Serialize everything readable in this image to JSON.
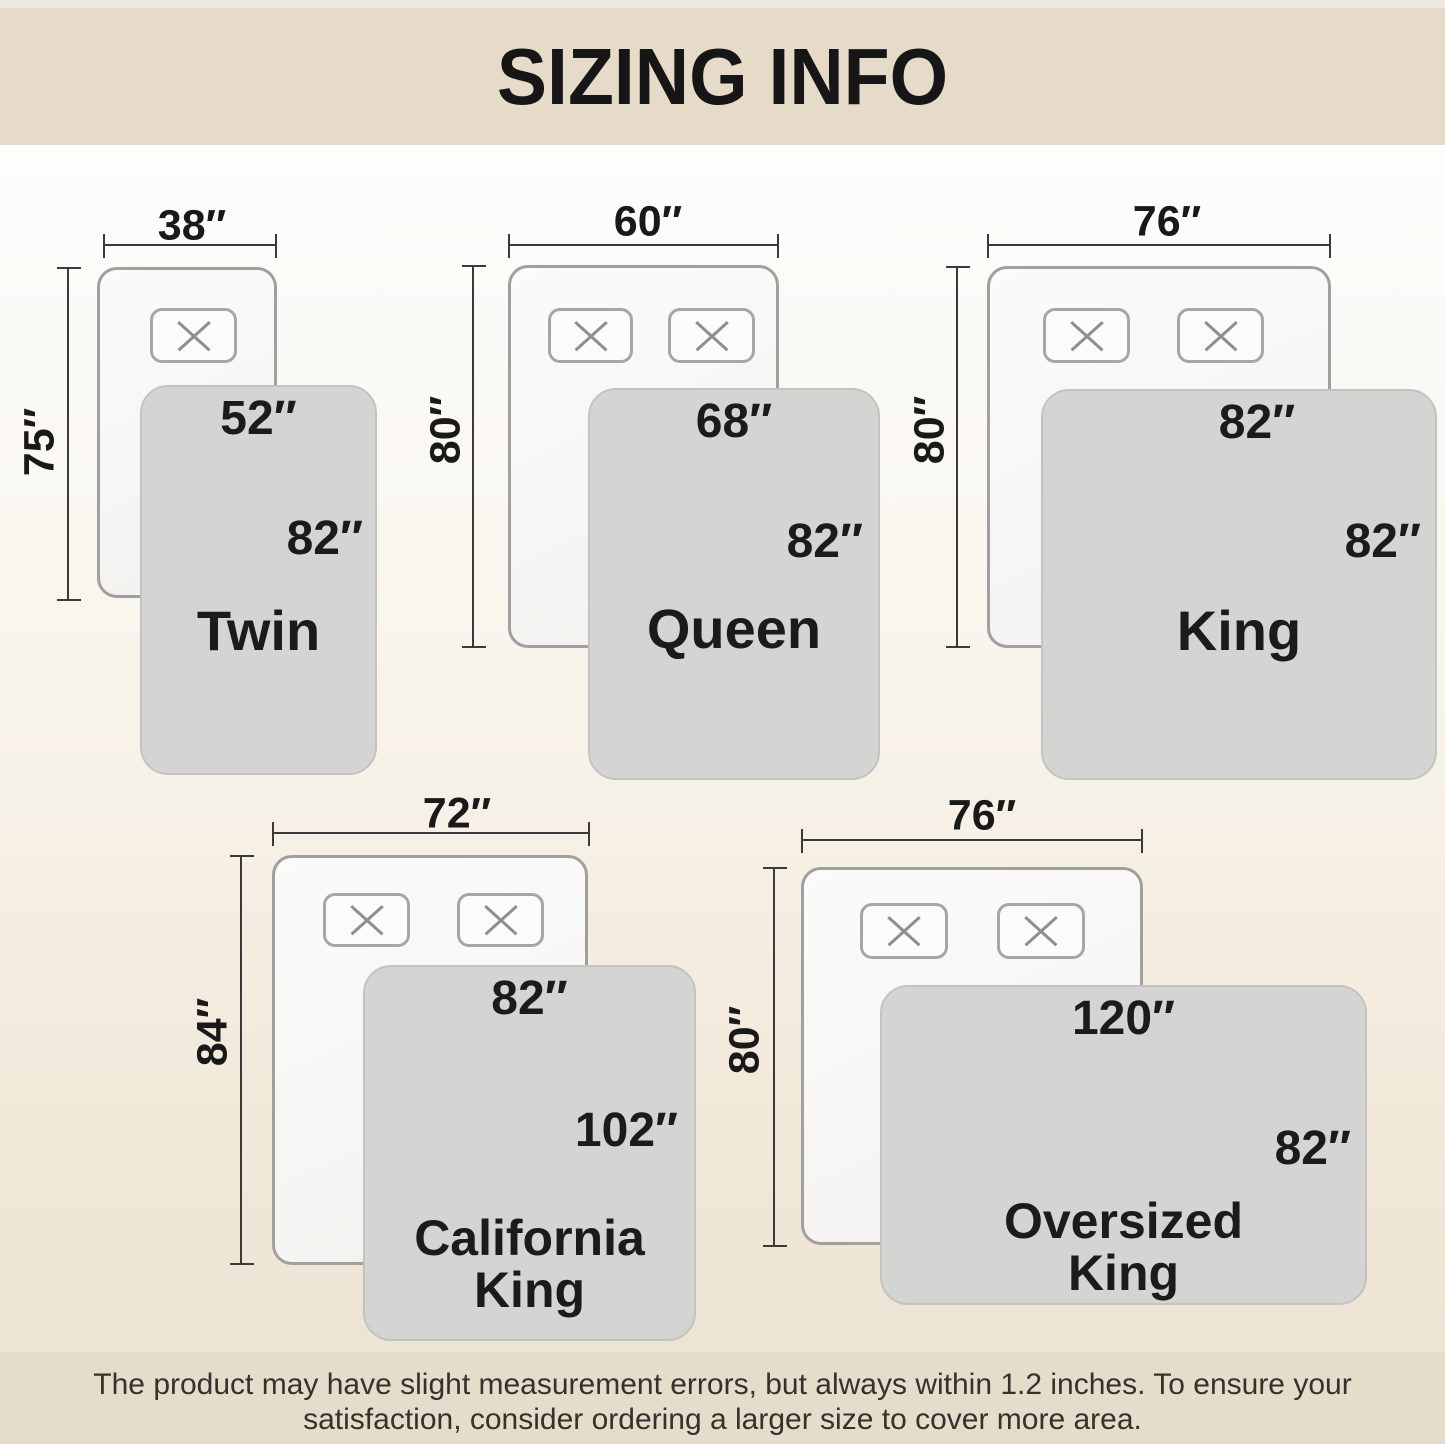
{
  "title": "SIZING INFO",
  "sizes": [
    {
      "name": "Twin",
      "bed_width": "38″",
      "bed_length": "75″",
      "blanket_width": "52″",
      "blanket_length": "82″"
    },
    {
      "name": "Queen",
      "bed_width": "60″",
      "bed_length": "80″",
      "blanket_width": "68″",
      "blanket_length": "82″"
    },
    {
      "name": "King",
      "bed_width": "76″",
      "bed_length": "80″",
      "blanket_width": "82″",
      "blanket_length": "82″"
    },
    {
      "name": "California King",
      "name_lines": [
        "California",
        "King"
      ],
      "bed_width": "72″",
      "bed_length": "84″",
      "blanket_width": "82″",
      "blanket_length": "102″"
    },
    {
      "name": "Oversized King",
      "name_lines": [
        "Oversized",
        "King"
      ],
      "bed_width": "76″",
      "bed_length": "80″",
      "blanket_width": "120″",
      "blanket_length": "82″"
    }
  ],
  "footer": {
    "line1": "The product may have slight measurement errors, but always within 1.2 inches. To ensure your",
    "line2": "satisfaction, consider ordering a larger size to cover more area."
  },
  "colors": {
    "header_bg": "#e5dbc8",
    "footer_bg": "#e6dccb",
    "background_top": "#fdfdfc",
    "background_bottom": "#ece2d2",
    "bed_fill": "#f9f8f6",
    "bed_border": "#a0a09e",
    "blanket_fill": "#d4d4d2",
    "dimension_line": "#3a3a38",
    "text": "#1b1b1b"
  }
}
